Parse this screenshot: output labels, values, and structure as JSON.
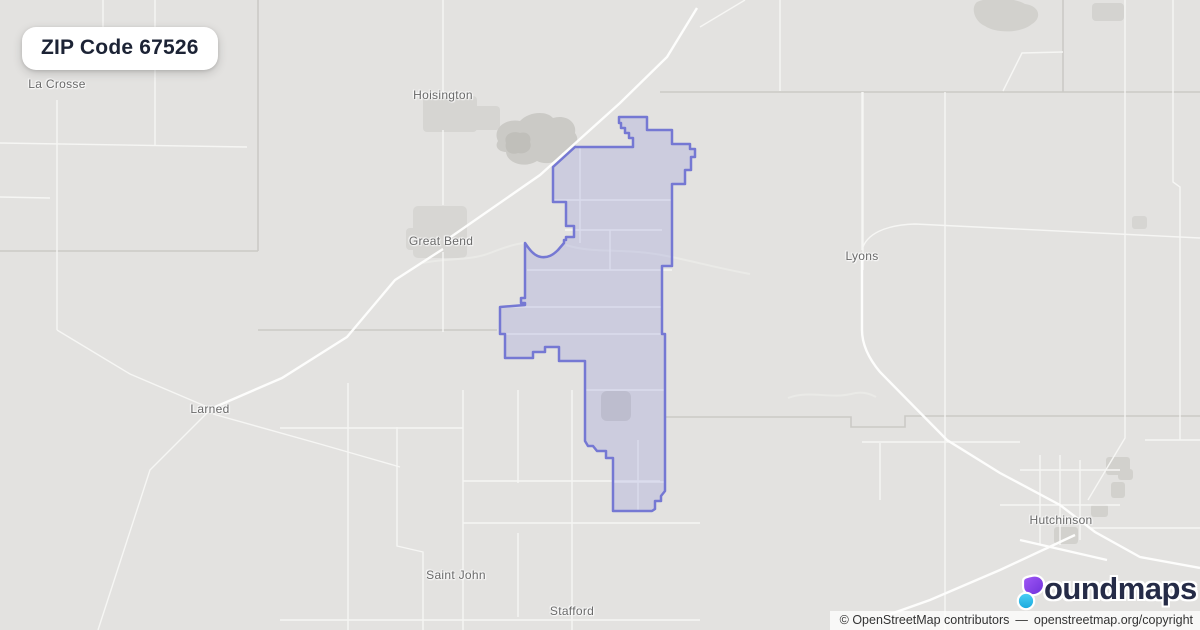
{
  "badge": {
    "title": "ZIP Code 67526"
  },
  "map": {
    "background_color": "#e3e2e0",
    "cities": [
      {
        "name": "La Crosse",
        "x": 57,
        "y": 84
      },
      {
        "name": "Hoisington",
        "x": 443,
        "y": 95
      },
      {
        "name": "Great Bend",
        "x": 441,
        "y": 241
      },
      {
        "name": "Lyons",
        "x": 862,
        "y": 256
      },
      {
        "name": "Larned",
        "x": 210,
        "y": 409
      },
      {
        "name": "Saint John",
        "x": 456,
        "y": 575
      },
      {
        "name": "Stafford",
        "x": 572,
        "y": 611
      },
      {
        "name": "Hutchinson",
        "x": 1061,
        "y": 520
      }
    ]
  },
  "zip_boundary": {
    "zip_code": "67526",
    "stroke_color": "#7578d3",
    "fill_color": "rgba(124,128,216,0.22)",
    "svg_path": "M619,117 L647,117 L647,130 L672,130 L672,144 L690,144 L690,149 L695,149 L695,157 L691,157 L691,170 L685,170 L685,184 L672,184 L672,266 L662,266 L662,334 L665,334 L665,491 L661,496 L661,501 L655,501 L655,509 L652,511 L613,511 L613,458 L606,458 L606,451 L597,451 L593,446 L588,446 L585,441 L585,361 L559,361 L559,347 L545,347 L545,352 L533,352 L533,358 L505,358 L505,334 L500,334 L500,307 L525,305 L525,303 L521,303 L521,298 L525,298 L525,243 C529,249 534,256 541,257 C548,258 553,255 558,250 L564,243 L564,240 L566,240 L566,237 L574,237 L574,226 L566,226 L566,202 L553,202 L553,167 L575,147 L633,147 L633,138 L629,138 L629,133 L625,133 L625,128 L621,128 L621,123 L619,123 Z"
  },
  "logo": {
    "brand": "boundmaps",
    "brand_rest": "oundmaps",
    "icon_purple_top": "#a259f7",
    "icon_purple_bottom": "#6d2fd9",
    "icon_cyan_top": "#4ed0f5",
    "icon_cyan_bottom": "#17a8dd"
  },
  "attribution": {
    "text": "© OpenStreetMap contributors",
    "separator": "—",
    "link": "openstreetmap.org/copyright"
  }
}
